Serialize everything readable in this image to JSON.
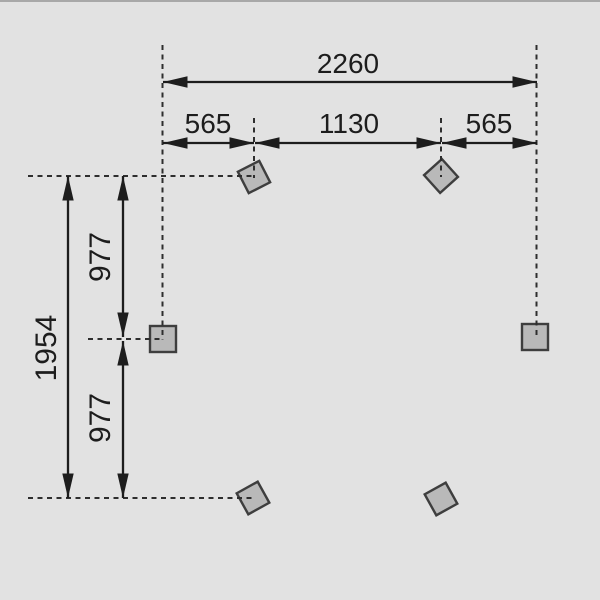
{
  "diagram": {
    "kind": "foundation-post-dimension-plan",
    "colors": {
      "background": "#e2e2e2",
      "line": "#1d1d1d",
      "dash": "#2e2e2e",
      "post_fill": "#b9b9b9",
      "post_stroke": "#3e3e3e",
      "top_edge": "#a8a8a8"
    },
    "dimensions": {
      "total_width": "2260",
      "left_offset": "565",
      "center_span": "1130",
      "right_offset": "565",
      "total_depth": "1954",
      "upper_depth": "977",
      "lower_depth": "977"
    },
    "posts": [
      {
        "id": "top-left",
        "cx": 254,
        "cy": 177,
        "size": 24,
        "rotation": 63
      },
      {
        "id": "top-right",
        "cx": 441,
        "cy": 176,
        "size": 24,
        "rotation": 48
      },
      {
        "id": "mid-left",
        "cx": 163,
        "cy": 339,
        "size": 26,
        "rotation": 0
      },
      {
        "id": "mid-right",
        "cx": 535,
        "cy": 337,
        "size": 26,
        "rotation": 0
      },
      {
        "id": "bottom-left",
        "cx": 253,
        "cy": 498,
        "size": 24,
        "rotation": 61
      },
      {
        "id": "bottom-right",
        "cx": 441,
        "cy": 499,
        "size": 24,
        "rotation": 61
      }
    ]
  }
}
